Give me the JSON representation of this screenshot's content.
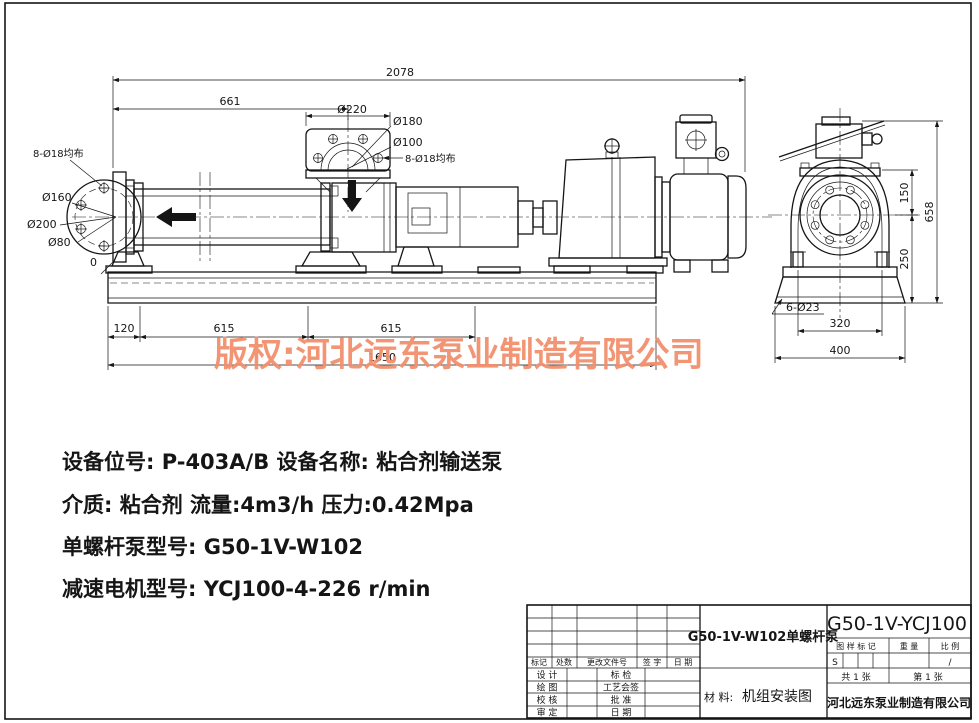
{
  "sheet": {
    "watermark": "版权:河北远东泵业制造有限公司",
    "watermark_color": "#F2906E"
  },
  "specs": {
    "line1": "设备位号: P-403A/B    设备名称: 粘合剂输送泵",
    "line2": "介质: 粘合剂  流量:4m3/h  压力:0.42Mpa",
    "line3": "单螺杆泵型号: G50-1V-W102",
    "line4": "减速电机型号: YCJ100-4-226 r/min"
  },
  "dims": {
    "total_length": "2078",
    "inlet_to_discharge": "661",
    "discharge_flange_od": "Ø220",
    "discharge_bolt_circle": "Ø180",
    "discharge_bore": "Ø100",
    "discharge_bolts": "8-Ø18均布",
    "suction_bolts": "8-Ø18均布",
    "suction_bolt_circle": "Ø160",
    "suction_flange_od": "Ø200",
    "suction_bore": "Ø80",
    "datum_zero": "0",
    "base_seg1": "120",
    "base_seg2": "615",
    "base_seg3": "615",
    "base_total": "1650",
    "end_flange_to_center": "150",
    "end_center_to_base": "250",
    "end_total_height": "658",
    "end_anchor_holes": "6-Ø23",
    "end_bolt_span": "320",
    "end_base_width": "400"
  },
  "title_block": {
    "rev_headers": [
      "标记",
      "处数",
      "更改文件号",
      "签 字",
      "日 期"
    ],
    "sign_left": [
      "设 计",
      "绘 图",
      "校 核",
      "审 定"
    ],
    "sign_right": [
      "标 检",
      "工艺会签",
      "批 准",
      "日 期"
    ],
    "drawing_title": "G50-1V-W102单螺杆泵",
    "material_label": "材 料:",
    "material_value": "机组安装图",
    "model": "G50-1V-YCJ100",
    "stamp_mark_label": "图 样 标 记",
    "stamp_weight_label": "重 量",
    "stamp_scale_label": "比 例",
    "stamp_mark_value": "S",
    "stamp_scale_value": "/",
    "sheets_total": "共 1 张",
    "sheet_number": "第 1 张",
    "company": "河北远东泵业制造有限公司"
  }
}
